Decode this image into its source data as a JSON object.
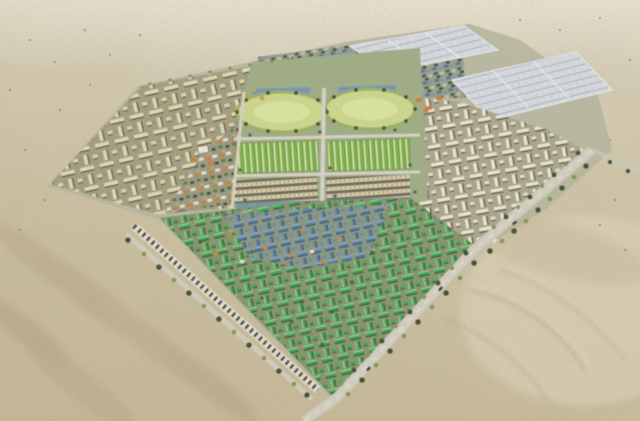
{
  "meta": {
    "type": "aerial-architectural-rendering",
    "description": "Bird's-eye 3D masterplan rendering of a large planned city built in open desert, viewed from the south-west at an oblique angle.",
    "environment": "desert",
    "visible_text": []
  },
  "palette": {
    "sand_base": "#d3c8ab",
    "sand_light": "#ded7c2",
    "sand_shadow": "#b3a383",
    "street_base": "#b7b7a0",
    "road": "#d4d0c2",
    "road_dash": "#f0efe6",
    "tree_dark": "#41502f",
    "tree_light": "#7b9a4c",
    "tan_building": "#e3dab6",
    "tan_ground": "#a49e80",
    "white_building": "#efe9d4",
    "green_building": "#3aa94e",
    "blue_building": "#4e7cb2",
    "orange_roof": "#d2852f",
    "field_green": "#cdd98e",
    "row_green": "#79b440",
    "row_tan": "#ddd2ab",
    "solar_panel": "#d9dde3",
    "teal_strip": "#6b93a8",
    "mixed_blue": "#5b7694"
  },
  "regions": [
    {
      "id": "desert",
      "label": "Surrounding desert sand with dunes and scrub",
      "color": "#d3c8ab"
    },
    {
      "id": "nw-residential",
      "label": "North-west beige courtyard housing maze",
      "color": "#e3dab6"
    },
    {
      "id": "north-district",
      "label": "Northern mixed blue/grey roof district with trees",
      "color": "#5b7694"
    },
    {
      "id": "central-campus",
      "label": "Central campus with two oval green sports fields and building rows",
      "color": "#cdd98e"
    },
    {
      "id": "green-rows",
      "label": "Rows of long green-roofed buildings",
      "color": "#79b440"
    },
    {
      "id": "tan-rows",
      "label": "Rows of long tan buildings",
      "color": "#ddd2ab"
    },
    {
      "id": "solar-arrays",
      "label": "Two large white panel arrays (north-east)",
      "color": "#d9dde3"
    },
    {
      "id": "east-residential",
      "label": "Eastern white courtyard housing maze",
      "color": "#efe9d4"
    },
    {
      "id": "south-residential",
      "label": "Southern diamond of green- and blue-roofed housing",
      "color": "#3aa74e"
    },
    {
      "id": "sw-strip",
      "label": "Long striped building row along the south-west edge",
      "color": "#e6e1cf"
    },
    {
      "id": "roads",
      "label": "Tree-lined perimeter roads with a few vehicles",
      "color": "#d4d0c2"
    }
  ],
  "features": {
    "oval_sports_fields": 2,
    "solar_panel_arrays": 2,
    "housing_mazes": 3,
    "perimeter_roads": true,
    "street_trees": true
  }
}
